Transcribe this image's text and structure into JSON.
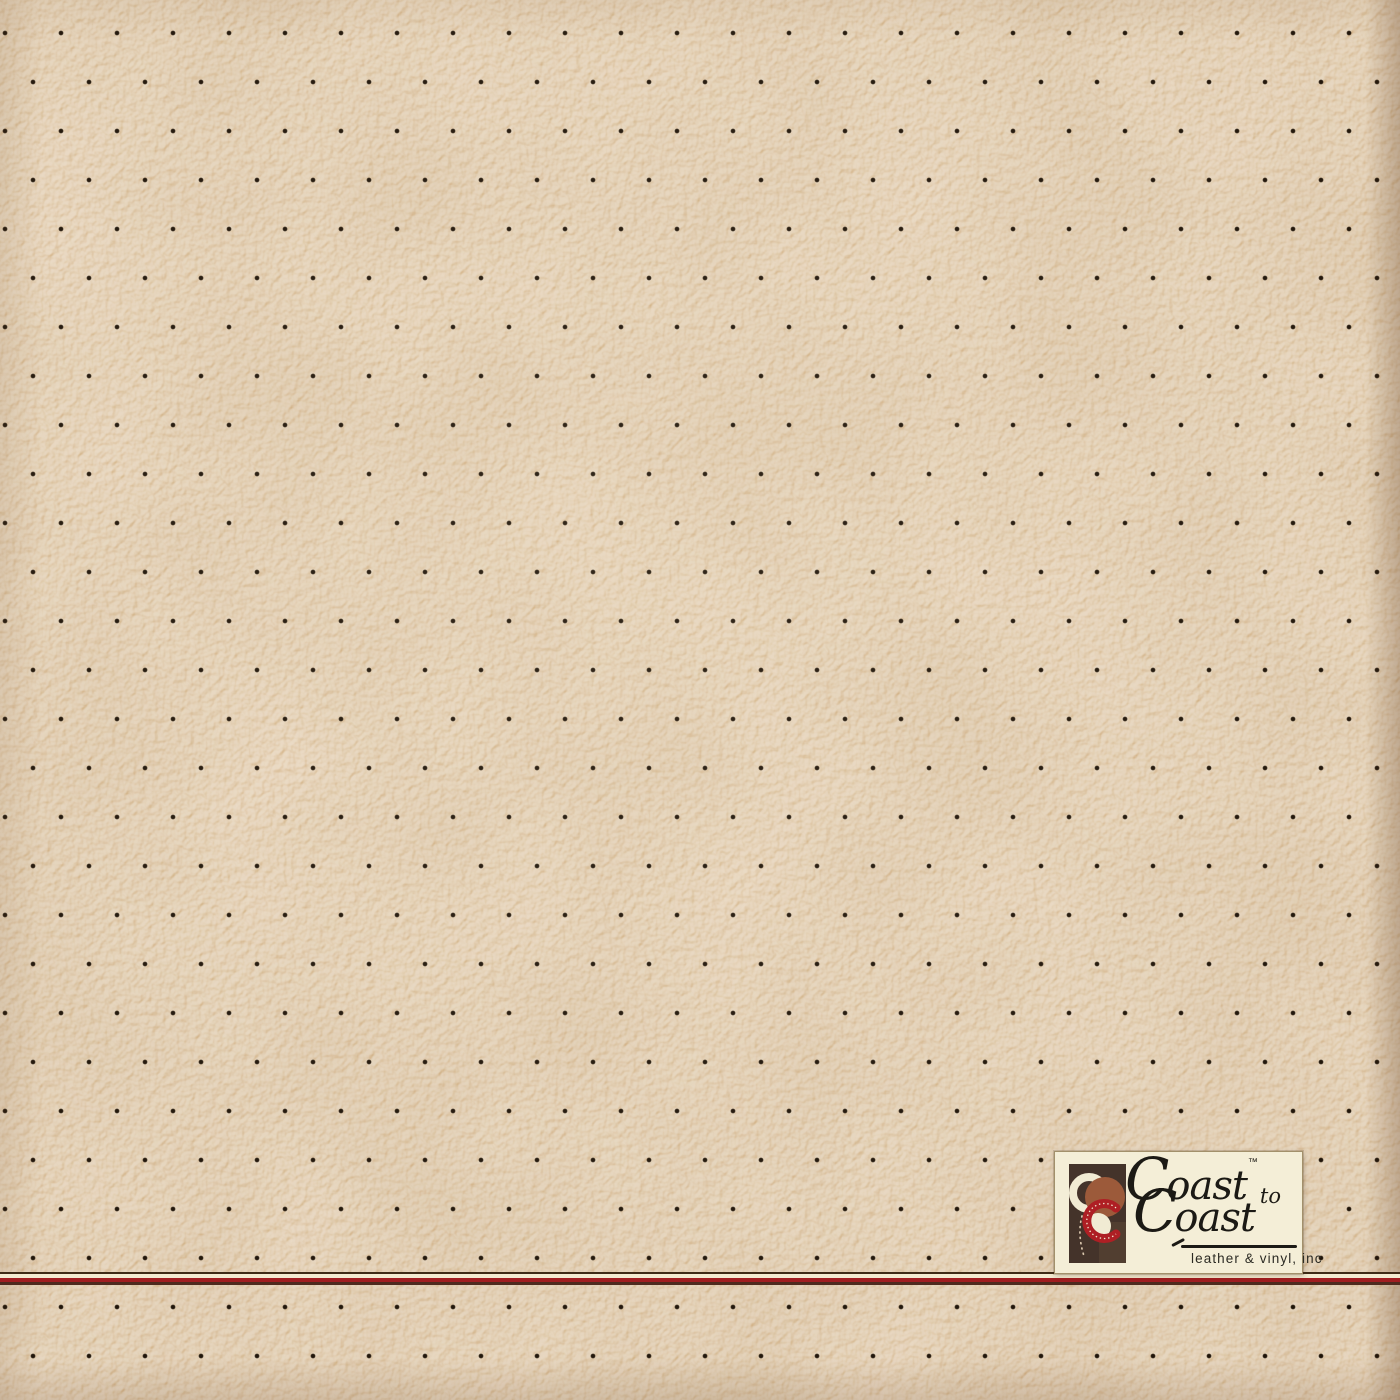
{
  "colors": {
    "leather": "#d3b183",
    "dot": "#1c1106",
    "stripe-top": "#3f2b16",
    "stripe-cream": "#f4ebd1",
    "stripe-red": "#a01d20",
    "stripe-bottom": "#4e2a1e",
    "badge-bg": "#f4eed7",
    "badge-border": "#a2906b",
    "logo-square": "#44332a",
    "logo-square-light": "#5c4734",
    "logo-cream": "#f1ebd3",
    "logo-sienna": "#9c5a3a",
    "logo-red": "#ae1f24",
    "ink": "#1c1a15"
  },
  "badge": {
    "brand_word_1": "Coast",
    "trademark": "™",
    "connector": "to",
    "brand_word_2": "Coast",
    "tagline": "leather & vinyl, inc"
  }
}
